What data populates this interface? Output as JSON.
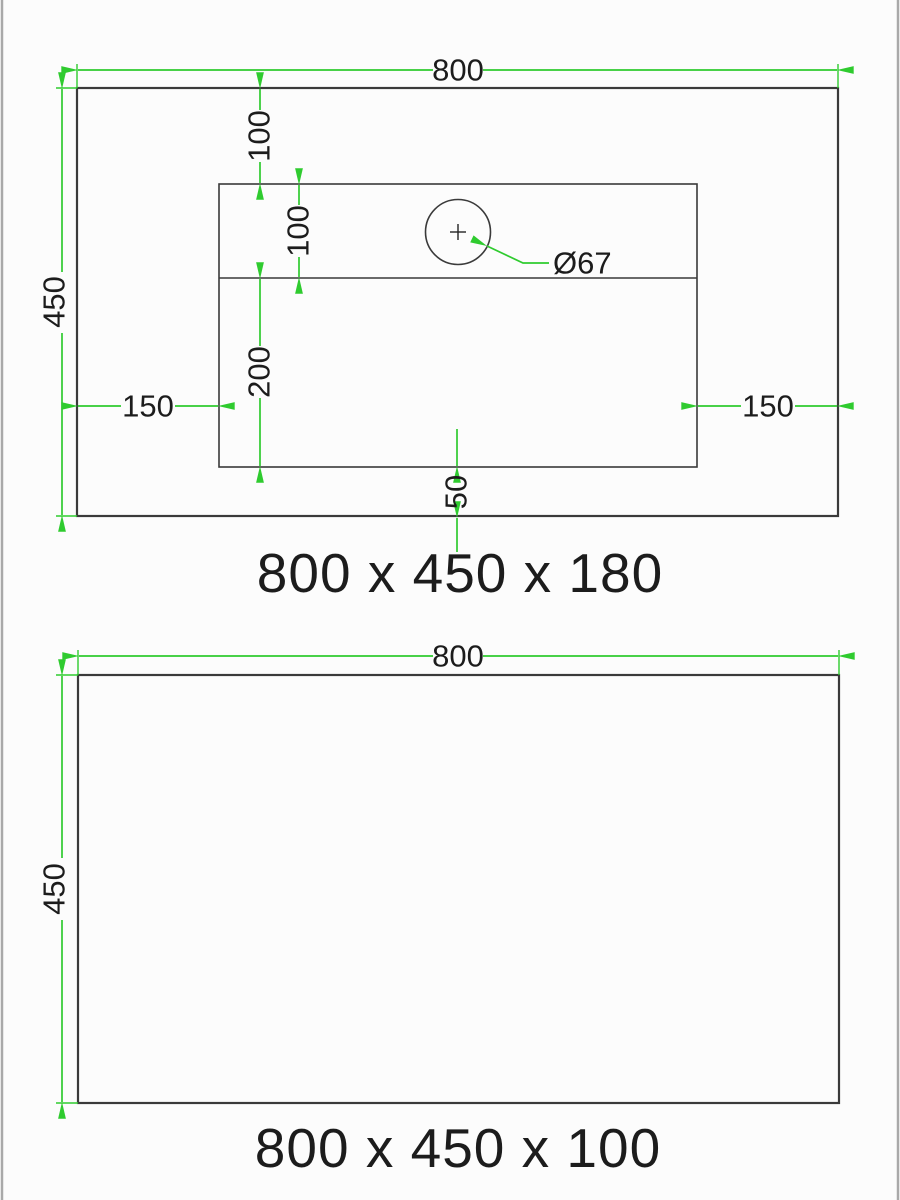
{
  "colors": {
    "accent_green": "#2fcb2f",
    "line_dark": "#3a3a3a",
    "text_ink": "#1c1c1c",
    "page_border": "#a9a9a9",
    "bg": "#fcfcfc"
  },
  "drawing_top": {
    "title": "800 x 450 x 180",
    "dim_width": "800",
    "dim_height": "450",
    "dim_hole_offset_top": "100",
    "dim_basin_band": "100",
    "dim_basin_depth": "200",
    "dim_bottom_gap": "50",
    "dim_left_offset": "150",
    "dim_right_offset": "150",
    "hole_diameter": "Ø67"
  },
  "drawing_bottom": {
    "title": "800 x 450 x 100",
    "dim_width": "800",
    "dim_height": "450"
  }
}
